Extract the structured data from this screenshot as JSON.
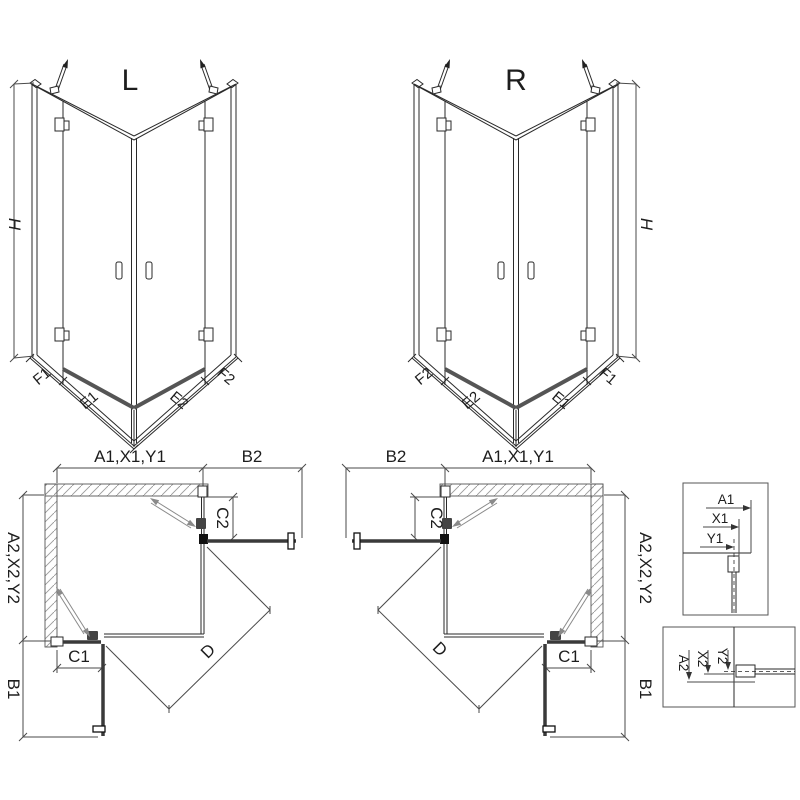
{
  "drawing": {
    "iso_left": {
      "title": "L",
      "height_dim": "H",
      "width_dims": [
        "F1",
        "E1",
        "E2",
        "F2"
      ]
    },
    "iso_right": {
      "title": "R",
      "height_dim": "H",
      "width_dims": [
        "F2",
        "E2",
        "E1",
        "F1"
      ]
    },
    "plan_left": {
      "top_dims": [
        "A1,X1,Y1",
        "B2"
      ],
      "side_dims": [
        "A2,X2,Y2",
        "B1"
      ],
      "inner_dims": {
        "c1": "C1",
        "c2": "C2",
        "d": "D"
      }
    },
    "plan_right": {
      "top_dims": [
        "B2",
        "A1,X1,Y1"
      ],
      "side_dims": [
        "A2,X2,Y2",
        "B1"
      ],
      "inner_dims": {
        "c1": "C1",
        "c2": "C2",
        "d": "D"
      }
    },
    "detail_horizontal": {
      "dims": [
        "A1",
        "X1",
        "Y1"
      ]
    },
    "detail_vertical": {
      "dims": [
        "A2",
        "X2",
        "Y2"
      ]
    },
    "colors": {
      "line": "#2a2a2a",
      "dim": "#4a4a4a",
      "panel": "#3a3a3a",
      "threshold": "#555555",
      "hatch": "#999999",
      "swing": "#8a8a8a",
      "background": "#ffffff"
    }
  }
}
